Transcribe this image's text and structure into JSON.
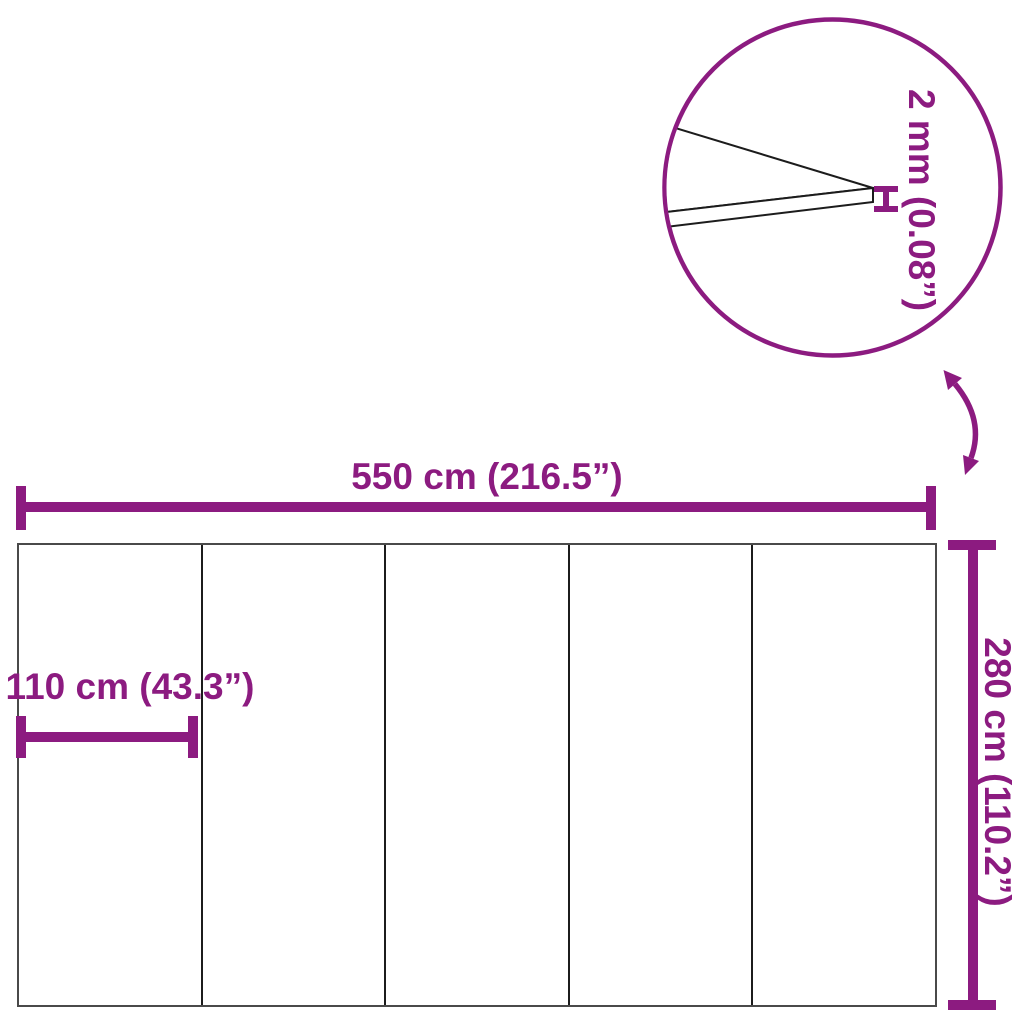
{
  "diagram": {
    "title": "sheet-dimension-diagram",
    "background_color": "#ffffff",
    "accent_color": "#8C1B80",
    "outline_color": "#4a4a4a",
    "detail_line_color": "#1c1c1c",
    "panel_count": 5,
    "dimensions": {
      "width": {
        "label": "550 cm (216.5”)"
      },
      "height": {
        "label": "280 cm (110.2”)"
      },
      "panel_width": {
        "label": "110 cm (43.3”)"
      },
      "thickness": {
        "label": "2 mm (0.08”)"
      }
    }
  }
}
